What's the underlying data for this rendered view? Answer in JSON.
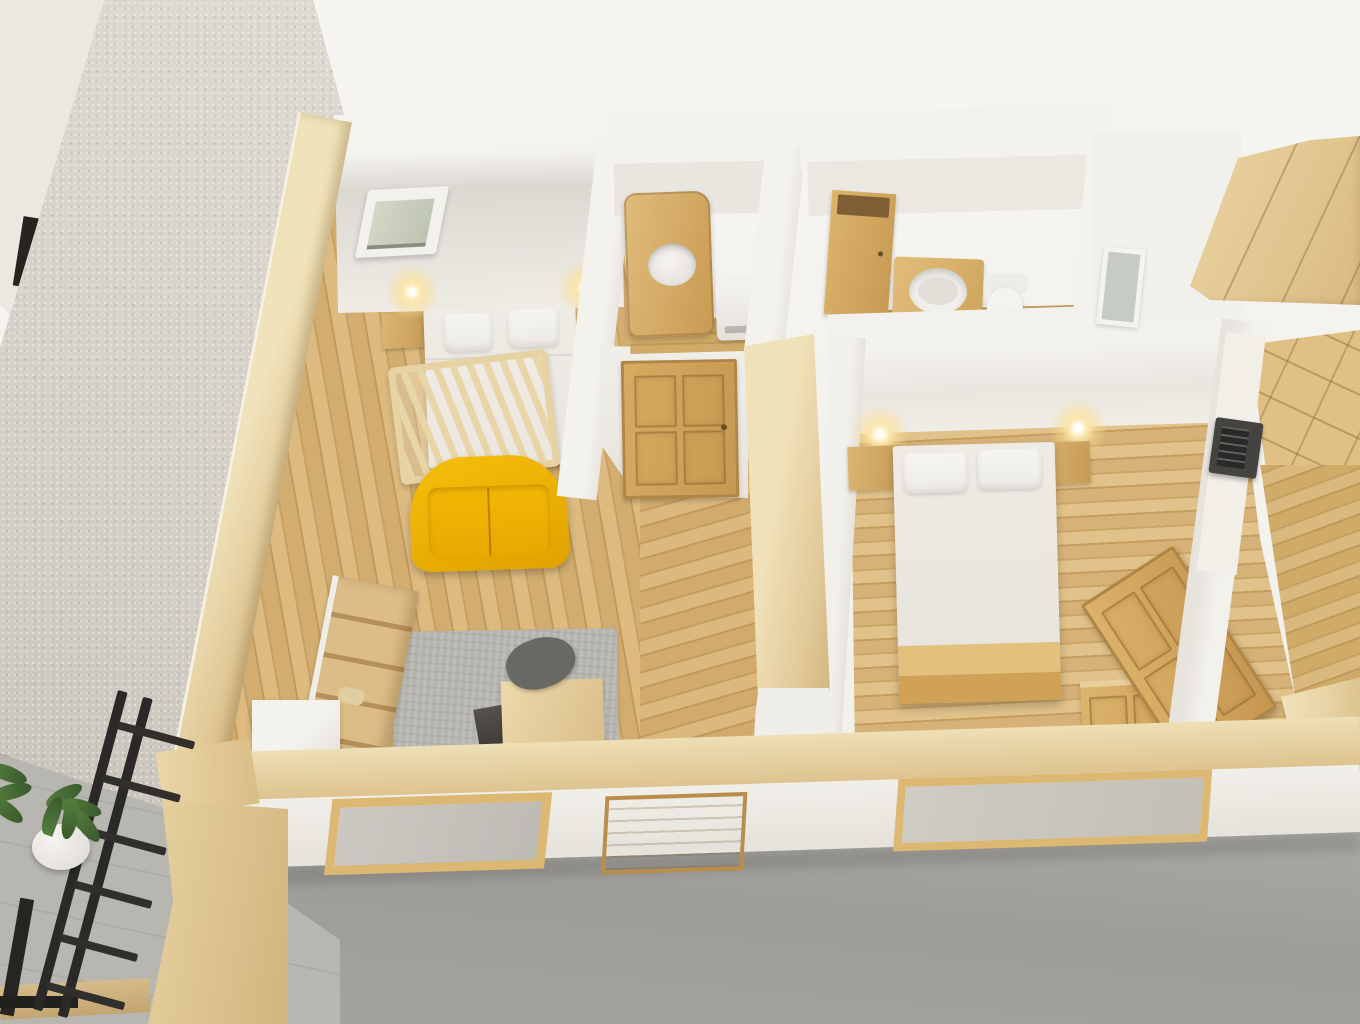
{
  "meta": {
    "scene_label": "Top-down 3D dollhouse render of a furnished miniature apartment model",
    "style_note": "white walls capped with light oak, oak plank floors, model standing on gray concrete"
  },
  "palette": {
    "wall_white": "#f3f1ec",
    "wall_shadow": "#e4e1db",
    "stucco_wall": "#d8d4cc",
    "wood_pale_cap": "#e8d5a9",
    "wood_floor": "#cda96a",
    "wood_furniture": "#d3a75e",
    "sofa_yellow": "#f0b405",
    "concrete_gray": "#a5a39e",
    "rug_gray": "#b6b4ae",
    "ladder_black": "#2a2927",
    "plant_green": "#4d7639",
    "lamp_glow": "#fbe7ae",
    "glass_pane": "#c9cfc3"
  },
  "rooms": [
    {
      "id": "studio-bedroom",
      "label": "Studio room with double bed, baby crib, yellow sofa, rug and desk"
    },
    {
      "id": "shower-room",
      "label": "Small room with wooden shower cabin and water heater"
    },
    {
      "id": "bathroom",
      "label": "Bathroom with tall cabinet, wooden vanity with round basin and toilet"
    },
    {
      "id": "bedroom-2",
      "label": "Second bedroom with double bed, nightstands and wall lamps"
    },
    {
      "id": "closet-room",
      "label": "Closet room with wooden wardrobes, counter and microwave"
    }
  ],
  "objects": {
    "exterior_wall": {
      "label": "Textured exterior wall seen from outside"
    },
    "wall_cap_left": {
      "label": "Light wood cap on left exterior wall"
    },
    "wall_cap_bottom": {
      "label": "Light wood cap on front exterior wall"
    },
    "skylight": {
      "label": "Small window in studio back wall"
    },
    "bed_main": {
      "label": "Double bed with two white pillows"
    },
    "nightstand": {
      "label": "Wooden nightstand"
    },
    "wall_lamp": {
      "label": "Glowing wall lamp"
    },
    "crib": {
      "label": "Wooden baby crib with slats"
    },
    "sofa": {
      "label": "Yellow two-seater sofa"
    },
    "shelf": {
      "label": "Wooden open shelving unit with decor"
    },
    "white_cabinet": {
      "label": "White corner cabinet"
    },
    "rug": {
      "label": "Gray textured area rug"
    },
    "lounge_chair": {
      "label": "Dark gray lounge chair"
    },
    "desk": {
      "label": "Light wood desk"
    },
    "interior_door": {
      "label": "Wooden four-panel interior door"
    },
    "partition_cap": {
      "label": "Wood-capped partition wall"
    },
    "shower_cabin": {
      "label": "Wooden shower cabin with round opening"
    },
    "water_heater": {
      "label": "White water heater unit"
    },
    "bathroom_cabinet": {
      "label": "Tall wooden bathroom cabinet"
    },
    "vanity_basin": {
      "label": "Wooden vanity with round white basin"
    },
    "toilet": {
      "label": "White toilet"
    },
    "bed_second": {
      "label": "Double bed with wooden foot frame"
    },
    "dresser": {
      "label": "Wooden dresser with panel drawers"
    },
    "leaning_door": {
      "label": "Wooden panel door leaning against wall"
    },
    "wardrobe_top_right": {
      "label": "Large wooden wardrobe, top view"
    },
    "wardrobe_closet": {
      "label": "Wooden paneled wardrobe in closet room"
    },
    "counter": {
      "label": "White counter ledge"
    },
    "microwave": {
      "label": "Dark microwave oven on counter"
    },
    "closet_window": {
      "label": "Small glazed opening"
    },
    "window_front_left": {
      "label": "Front facade window, wooden frame"
    },
    "entry_door": {
      "label": "Front facade wooden door"
    },
    "window_front_right": {
      "label": "Wide front facade window, wooden frame"
    },
    "ladder": {
      "label": "Black metal ladder leaning outside"
    },
    "plant_large": {
      "label": "Green plant in white pot"
    },
    "plant_small": {
      "label": "Green plant at image edge"
    },
    "platform": {
      "label": "Wooden platform at model corner"
    },
    "concrete_ground": {
      "label": "Gray concrete floor around the model"
    }
  }
}
